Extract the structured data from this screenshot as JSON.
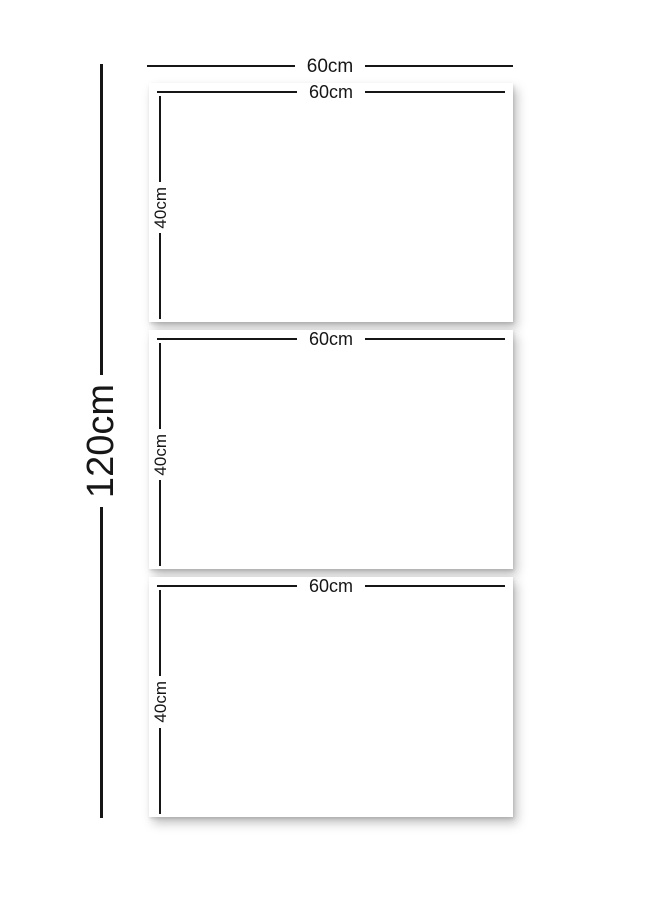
{
  "diagram": {
    "type": "product-dimension-diagram",
    "description": "Three-panel (triptych) canvas size diagram",
    "outer": {
      "width_label": "60cm",
      "height_label": "120cm"
    },
    "panels": [
      {
        "width_label": "60cm",
        "height_label": "40cm"
      },
      {
        "width_label": "60cm",
        "height_label": "40cm"
      },
      {
        "width_label": "60cm",
        "height_label": "40cm"
      }
    ],
    "colors": {
      "line": "#161616",
      "text": "#161616",
      "background": "#ffffff",
      "panel": "#ffffff"
    }
  }
}
